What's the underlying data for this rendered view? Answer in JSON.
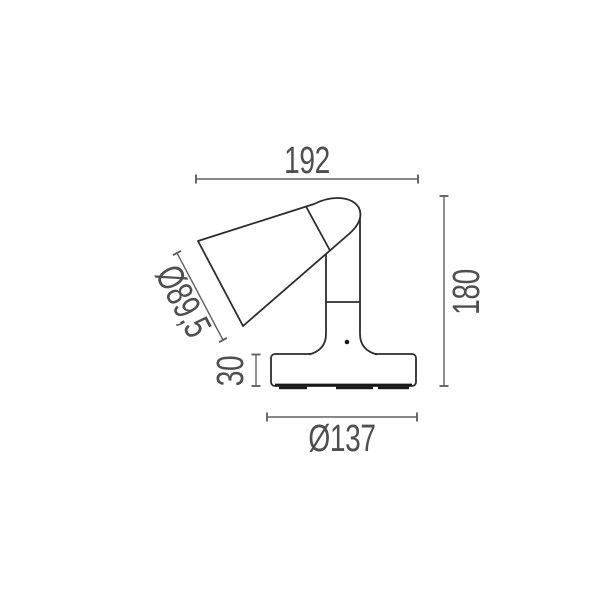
{
  "dimensions": {
    "overall_width": {
      "label": "192",
      "value": 192
    },
    "overall_height": {
      "label": "180",
      "value": 180
    },
    "shade_diameter": {
      "label": "Ø89,5",
      "value": 89.5
    },
    "base_height": {
      "label": "30",
      "value": 30
    },
    "base_diameter": {
      "label": "Ø137",
      "value": 137
    }
  },
  "colors": {
    "bg": "#ffffff",
    "outline": "#2d2d2d",
    "dark": "#1a1a1a",
    "dim": "#616161",
    "text": "#4f4f4f"
  }
}
